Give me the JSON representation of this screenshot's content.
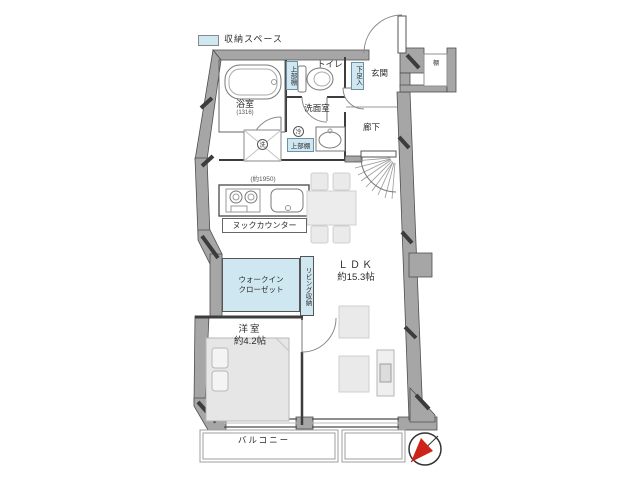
{
  "legend": {
    "storage": "収納スペース"
  },
  "rooms": {
    "bathroom": {
      "name": "浴室",
      "size": "(1316)"
    },
    "toilet": "トイレ",
    "washroom": "洗面室",
    "entrance": "玄関",
    "hallway": "廊下",
    "ldk": {
      "name": "ＬＤＫ",
      "size": "約15.3帖"
    },
    "bedroom": {
      "name": "洋室",
      "size": "約4.2帖"
    },
    "wic": {
      "line1": "ウォークイン",
      "line2": "クローゼット"
    },
    "living_storage": "リビング収納",
    "balcony": "バルコニー"
  },
  "fixtures": {
    "upper_shelf_toilet": "上部棚",
    "upper_shelf_kitchen": "上部棚",
    "shoe_cabinet": "下足入",
    "shelf": "棚",
    "washer_mark": "洗",
    "fridge_mark": "冷",
    "counter_width": "(約1950)",
    "nook_counter": "ヌックカウンター"
  },
  "colors": {
    "storage_fill": "#cfe7f1",
    "wall_fill": "#a6a6a6",
    "furniture_fill": "#eaeaea",
    "compass_red": "#cc2418"
  }
}
